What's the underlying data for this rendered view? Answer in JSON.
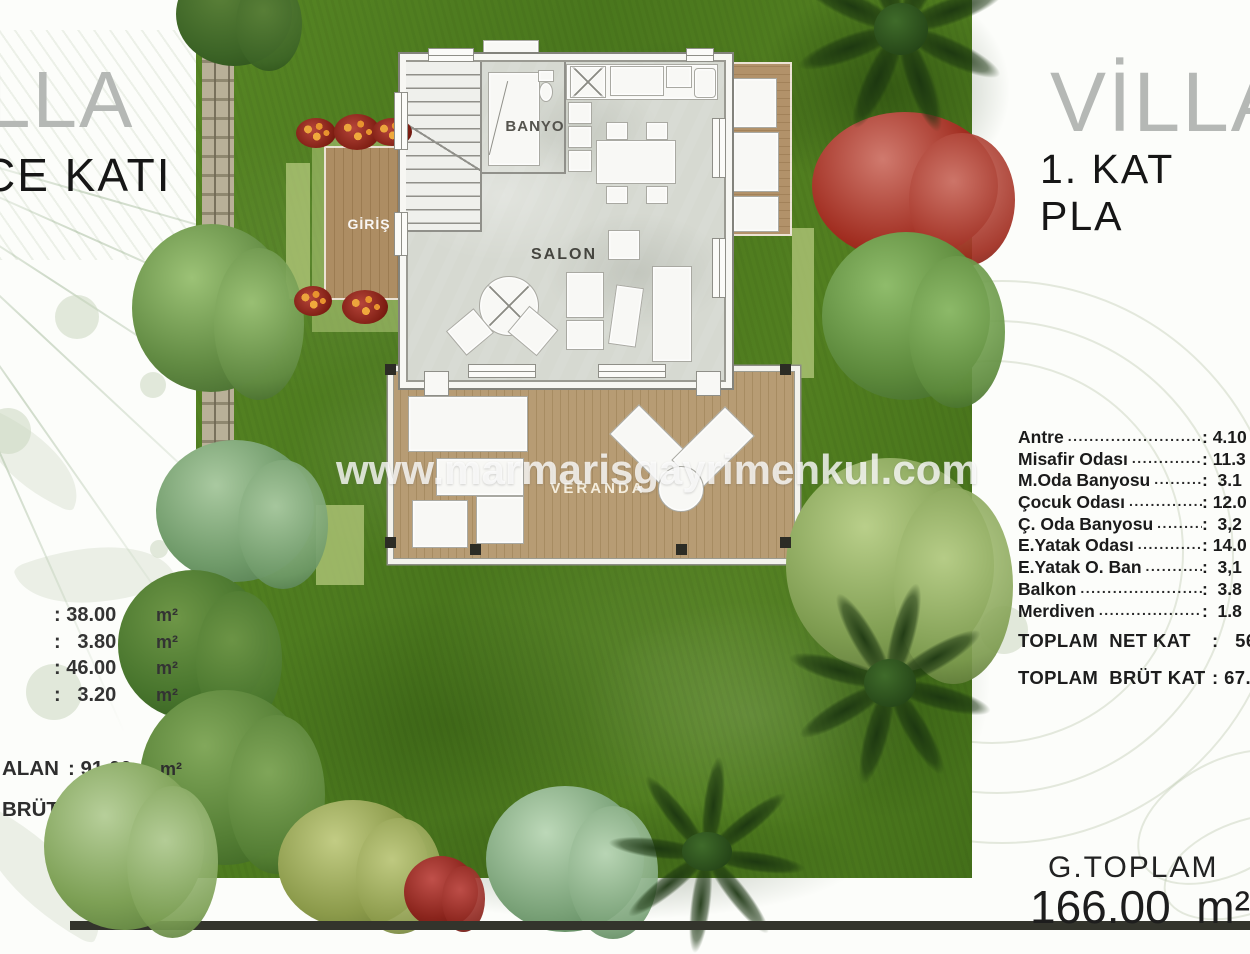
{
  "watermark": {
    "text": "www.marmarisgayrimenkul.com"
  },
  "left_panel": {
    "title_fragment": "LLA",
    "subtitle_fragment": "CE KATI",
    "area_rows": [
      {
        "value": ": 38.00",
        "unit": "m²"
      },
      {
        "value": ":   3.80",
        "unit": "m²"
      },
      {
        "value": ": 46.00",
        "unit": "m²"
      },
      {
        "value": ":   3.20",
        "unit": "m²"
      }
    ],
    "summary_rows": [
      {
        "label": "ALAN",
        "value": ": 91.00",
        "unit": "m²"
      },
      {
        "label": "BRÜT",
        "value": ": 98.10",
        "unit": "m²"
      }
    ]
  },
  "right_panel": {
    "title": "VİLLA",
    "subtitle": "1. KAT PLA",
    "rooms": [
      {
        "label": "Antre",
        "dots": "............................",
        "value": ": 4.10"
      },
      {
        "label": "Misafir Odası",
        "dots": "................",
        "value": ": 11.3"
      },
      {
        "label": "M.Oda Banyosu",
        "dots": "............",
        "value": ":  3.1"
      },
      {
        "label": "Çocuk Odası",
        "dots": "................",
        "value": ": 12.0"
      },
      {
        "label": "Ç. Oda Banyosu",
        "dots": "..........",
        "value": ":  3,2"
      },
      {
        "label": "E.Yatak Odası",
        "dots": "............",
        "value": ": 14.0"
      },
      {
        "label": "E.Yatak O. Ban",
        "dots": "............",
        "value": ":  3,1"
      },
      {
        "label": "Balkon",
        "dots": "..........................",
        "value": ":  3.8"
      },
      {
        "label": "Merdiven",
        "dots": "......................",
        "value": ":  1.8"
      }
    ],
    "totals": [
      {
        "label": "TOPLAM  NET KAT",
        "value": ":   56."
      },
      {
        "label": "TOPLAM  BRÜT KAT",
        "value": ": 67.9"
      }
    ],
    "grand_total": {
      "label": "G.TOPLAM",
      "value": "166.00  m²"
    }
  },
  "floor_plan": {
    "banyo": "BANYO",
    "salon": "SALON",
    "giris": "GİRİŞ",
    "veranda": "VERANDA"
  }
}
